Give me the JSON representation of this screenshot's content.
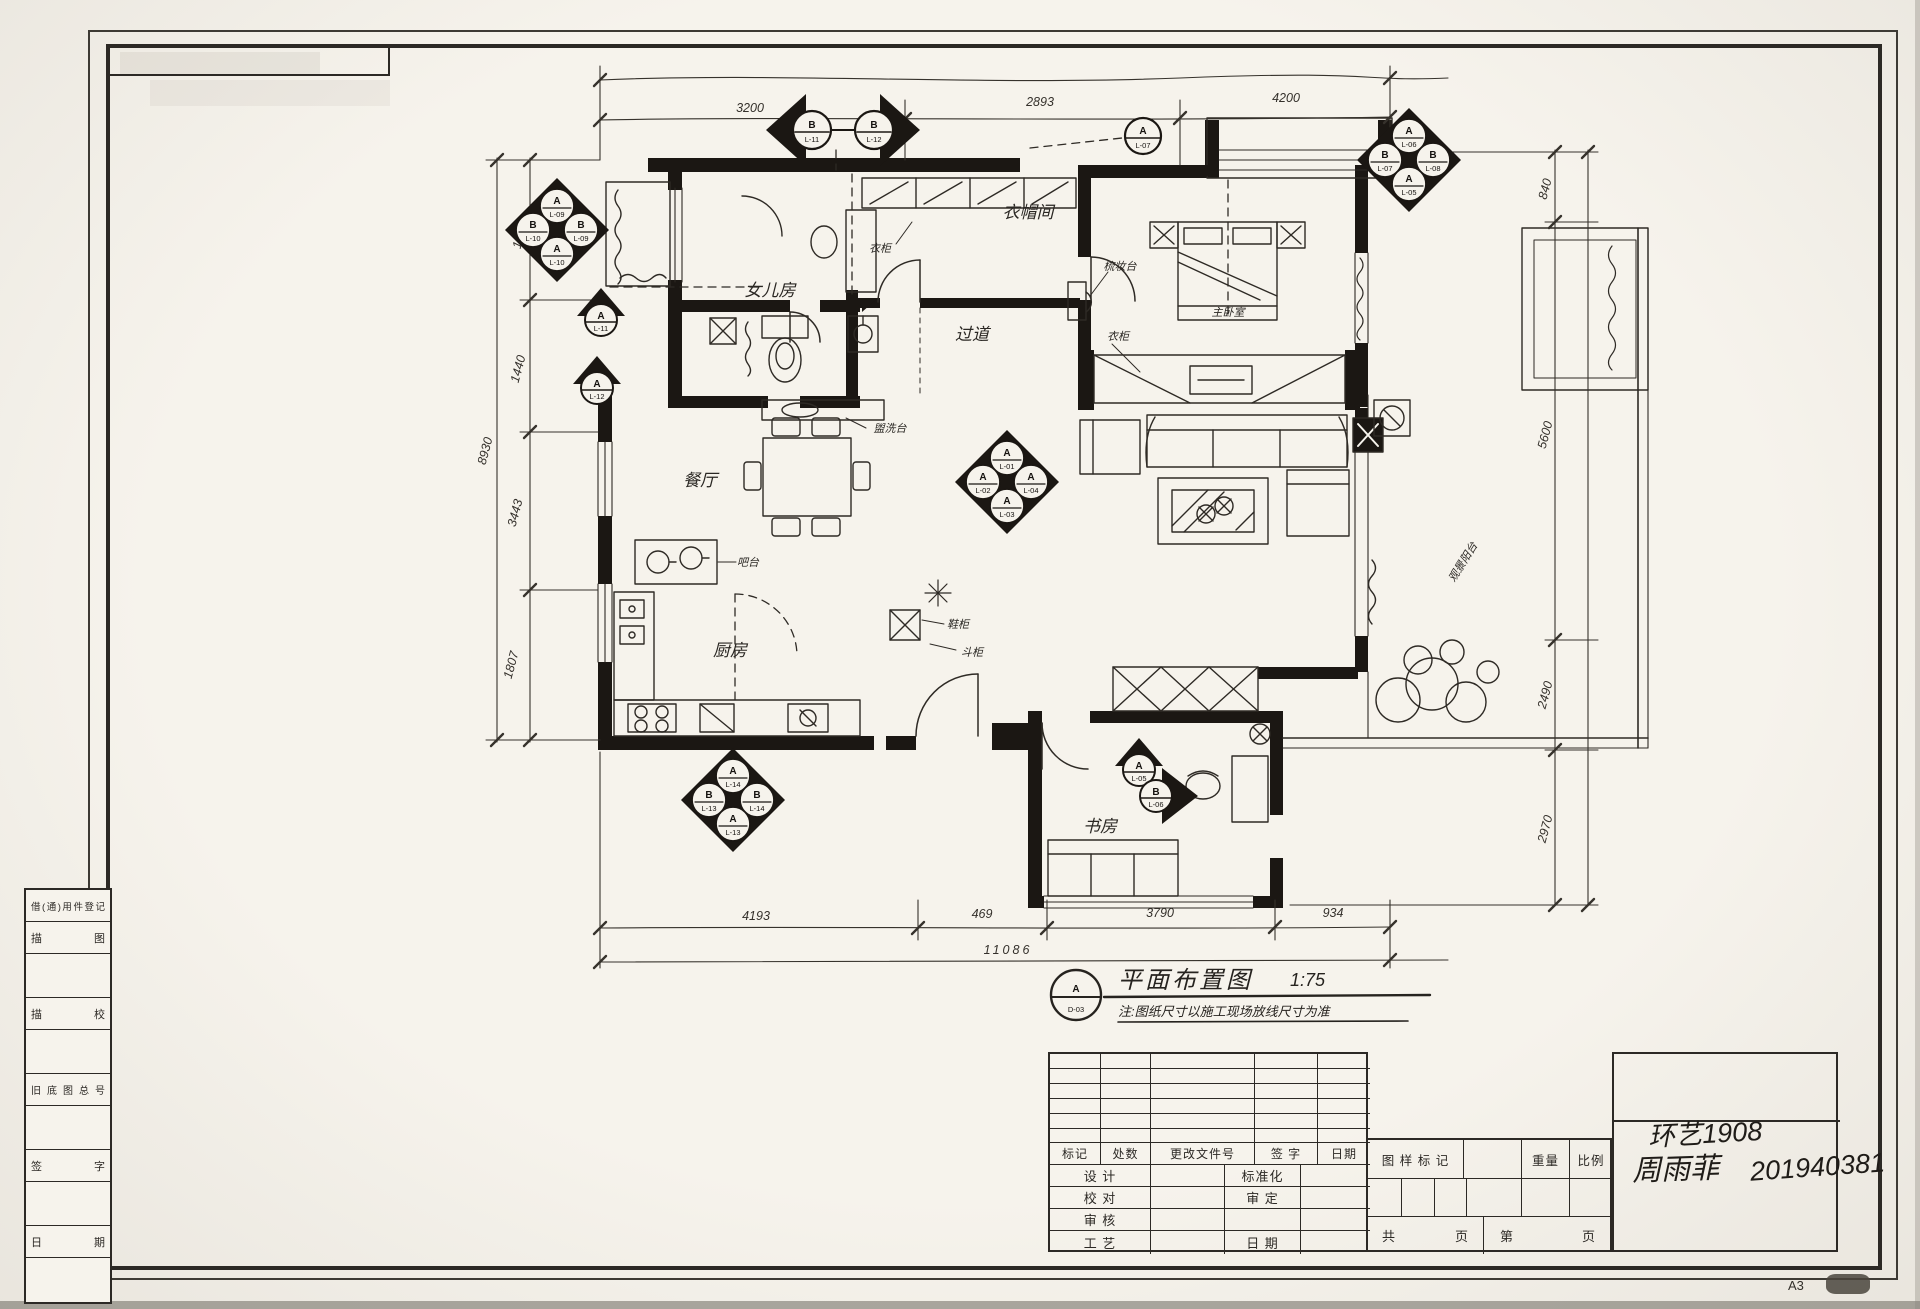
{
  "sheet": {
    "size": "A3"
  },
  "sidebar": {
    "rows": [
      "借(通)用件登记",
      "描图",
      "",
      "描校",
      "",
      "旧底图总号",
      "",
      "签字",
      "",
      "日期",
      ""
    ]
  },
  "titleblock": {
    "rev_cols": [
      "标记",
      "处数",
      "更改文件号",
      "签 字",
      "日期"
    ],
    "rows": [
      {
        "l": "设 计",
        "r": "标准化"
      },
      {
        "l": "校 对",
        "r": "审 定"
      },
      {
        "l": "审 核",
        "r": ""
      },
      {
        "l": "工 艺",
        "r": "日 期"
      }
    ],
    "stamp_label": "图 样 标 记",
    "weight_label": "重量",
    "scale_label": "比例",
    "pages": {
      "a": "共",
      "b": "页",
      "c": "第",
      "d": "页"
    },
    "hand_class": "环艺1908",
    "hand_name": "周雨菲",
    "hand_id": "201940381",
    "size_tag": "A3"
  },
  "plan": {
    "title": {
      "letter": "A",
      "code": "D-03",
      "name": "平面布置图",
      "scale": "1:75",
      "note": "注:图纸尺寸以施工现场放线尺寸为准"
    },
    "rooms": {
      "daughter": "女儿房",
      "cloak": "衣帽间",
      "master": "主卧室",
      "hall": "过道",
      "dining": "餐厅",
      "kitchen": "厨房",
      "study": "书房",
      "balcony": "观景阳台",
      "bar": "吧台"
    },
    "furniture": {
      "wardrobe1": "衣柜",
      "wardrobe2": "衣柜",
      "dresser": "梳妆台",
      "shoe_cabinet": "鞋柜",
      "chest": "斗柜",
      "washbasin": "盥洗台"
    },
    "dims": {
      "top": [
        "3200",
        "2893",
        "4200"
      ],
      "left": {
        "total": "8930",
        "segments": [
          "1812",
          "1440",
          "3443",
          "1807"
        ]
      },
      "right": [
        "840",
        "5600",
        "2490",
        "2970"
      ],
      "bottom": {
        "total": "11086",
        "segments": [
          "4193",
          "469",
          "3790",
          "934"
        ]
      }
    },
    "markers": {
      "pair_left": {
        "letter": "B",
        "code": "L-11"
      },
      "pair_right": {
        "letter": "B",
        "code": "L-12"
      },
      "top_circle": {
        "letter": "A",
        "code": "L-07"
      },
      "tr": {
        "top": {
          "letter": "A",
          "code": "L-06"
        },
        "left": {
          "letter": "B",
          "code": "L-07"
        },
        "right": {
          "letter": "B",
          "code": "L-08"
        },
        "bottom": {
          "letter": "A",
          "code": "L-05"
        }
      },
      "west": {
        "top": {
          "letter": "A",
          "code": "L-09"
        },
        "left": {
          "letter": "B",
          "code": "L-10"
        },
        "right": {
          "letter": "B",
          "code": "L-09"
        },
        "bottom": {
          "letter": "A",
          "code": "L-10"
        }
      },
      "west_single1": {
        "letter": "A",
        "code": "L-11"
      },
      "west_single2": {
        "letter": "A",
        "code": "L-12"
      },
      "living": {
        "top": {
          "letter": "A",
          "code": "L-01"
        },
        "left": {
          "letter": "A",
          "code": "L-02"
        },
        "right": {
          "letter": "A",
          "code": "L-04"
        },
        "bottom": {
          "letter": "A",
          "code": "L-03"
        }
      },
      "south": {
        "top": {
          "letter": "A",
          "code": "L-14"
        },
        "left": {
          "letter": "B",
          "code": "L-13"
        },
        "right": {
          "letter": "B",
          "code": "L-14"
        },
        "bottom": {
          "letter": "A",
          "code": "L-13"
        }
      },
      "study_up": {
        "letter": "A",
        "code": "L-05"
      },
      "study_right": {
        "letter": "B",
        "code": "L-06"
      }
    }
  }
}
